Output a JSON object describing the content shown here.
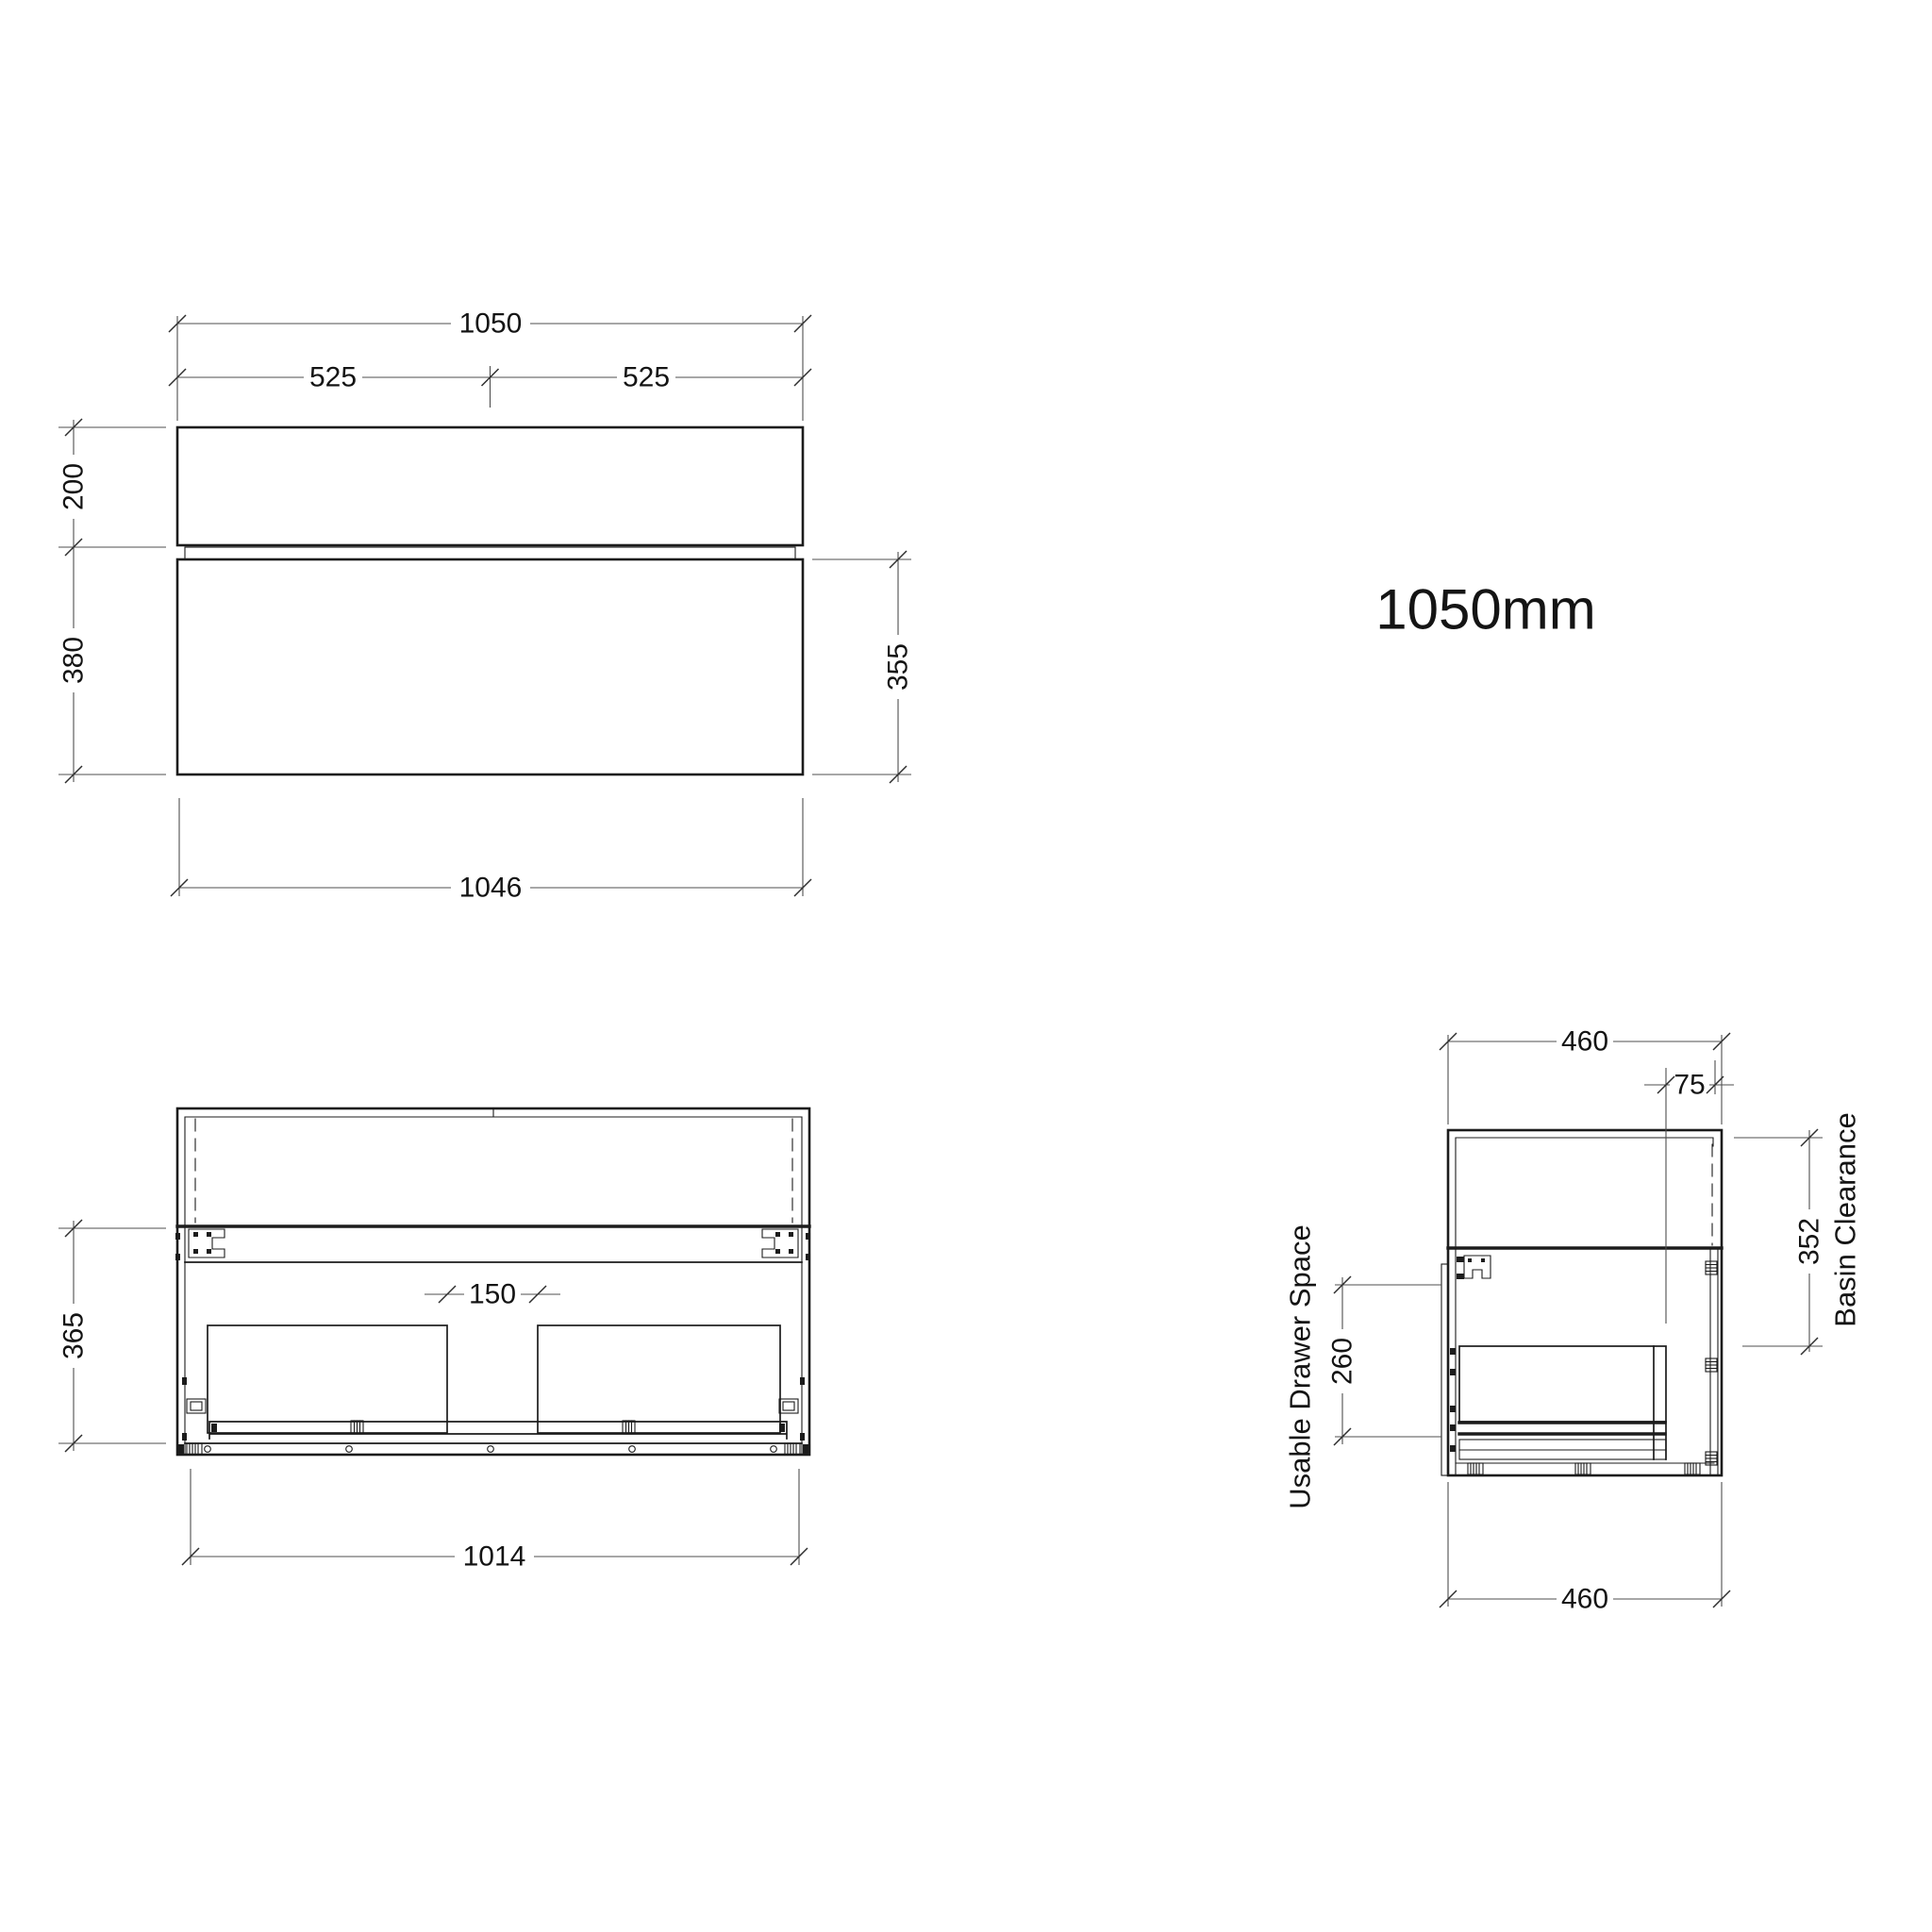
{
  "drawing": {
    "product_label": "1050mm",
    "front_elevation": {
      "overall_width": "1050",
      "half_width_left": "525",
      "half_width_right": "525",
      "top_drawer_height": "200",
      "bottom_drawer_height": "380",
      "drawer_front_height": "355",
      "carcass_width": "1046"
    },
    "front_internal": {
      "drawer_gap": "150",
      "carcass_side_height": "365",
      "internal_width": "1014"
    },
    "side_section": {
      "depth_top": "460",
      "edge_offset": "75",
      "basin_clearance_value": "352",
      "basin_clearance_label": "Basin Clearance",
      "usable_drawer_value": "260",
      "usable_drawer_label": "Usable Drawer Space",
      "depth_bottom": "460"
    }
  }
}
